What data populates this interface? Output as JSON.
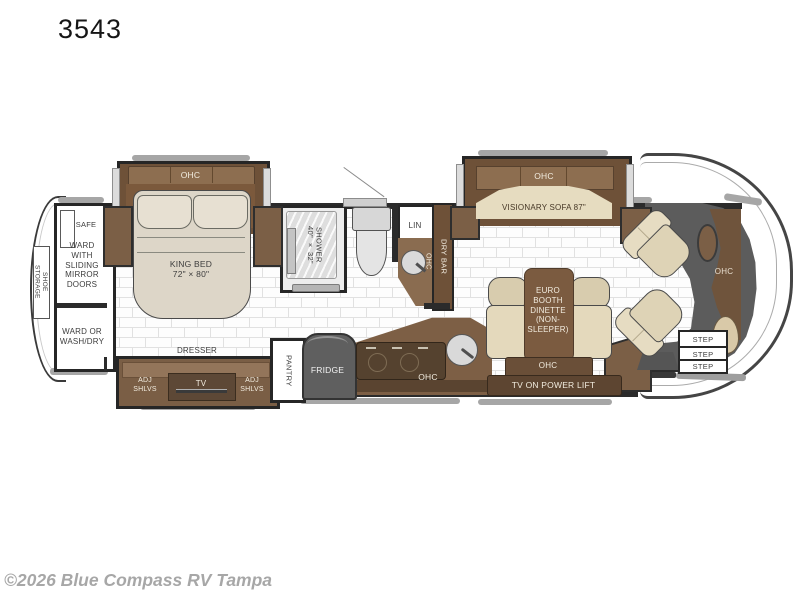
{
  "header": {
    "model": "3543"
  },
  "footer": {
    "watermark": "©2026 Blue Compass RV Tampa"
  },
  "rear": {
    "shoe_storage": "SHOE\nSTORAGE",
    "safe": "SAFE",
    "ward_sliding": "WARD\nWITH\nSLIDING\nMIRROR\nDOORS",
    "ward_washdry": "WARD OR\nWASH/DRY"
  },
  "bedroom": {
    "ohc": "OHC",
    "king_bed": "KING BED\n72\" × 80\"",
    "dresser": "DRESSER",
    "adj_shlvs_left": "ADJ\nSHLVS",
    "tv": "TV",
    "adj_shlvs_right": "ADJ\nSHLVS"
  },
  "bath": {
    "shower": "SHOWER\n40\" × 32\"",
    "lin": "LIN",
    "dry_bar": "DRY BAR",
    "ohc": "OHC"
  },
  "kitchen": {
    "pantry": "PANTRY",
    "fridge": "FRIDGE",
    "ohc": "OHC"
  },
  "living": {
    "sofa_ohc": "OHC",
    "sofa": "VISIONARY SOFA 87\"",
    "dinette": "EURO\nBOOTH\nDINETTE\n(NON-\nSLEEPER)",
    "dinette_ohc": "OHC",
    "tv_lift": "TV ON POWER LIFT"
  },
  "front": {
    "ohc": "OHC",
    "steps": [
      "STEP",
      "STEP",
      "STEP"
    ]
  }
}
